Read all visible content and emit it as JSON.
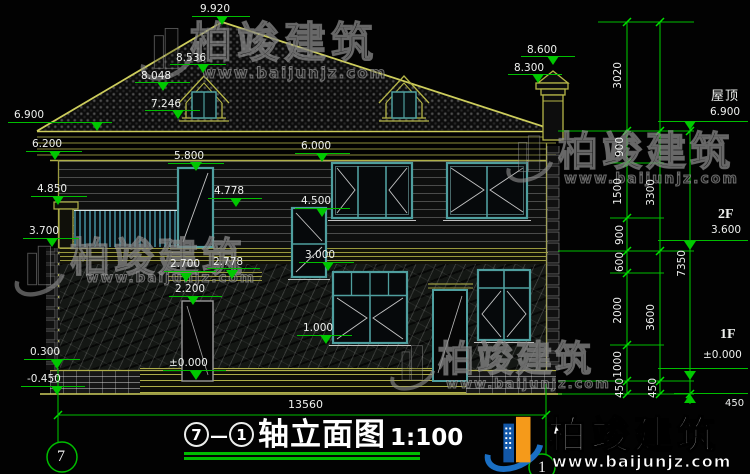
{
  "watermark": {
    "company": "柏竣建筑",
    "website": "www.baijunjz.com"
  },
  "title": {
    "axis_start": "7",
    "separator": "—",
    "axis_end": "1",
    "text": "轴立面图",
    "scale": "1:100"
  },
  "axis_bubbles": {
    "left": "7",
    "right": "1"
  },
  "overall_dimension": "13560",
  "annotations": {
    "levels": [
      {
        "text": "9.920",
        "x": 200,
        "y": 3,
        "line": [
          192,
          250,
          16
        ],
        "tri": [
          222,
          25
        ]
      },
      {
        "text": "8.536",
        "x": 176,
        "y": 52,
        "line": [
          170,
          226,
          64
        ],
        "tri": [
          203,
          73
        ]
      },
      {
        "text": "8.048",
        "x": 141,
        "y": 70,
        "line": [
          135,
          190,
          82
        ],
        "tri": [
          163,
          91
        ]
      },
      {
        "text": "7.246",
        "x": 151,
        "y": 98,
        "line": [
          145,
          200,
          110
        ],
        "tri": [
          178,
          119
        ]
      },
      {
        "text": "8.600",
        "x": 527,
        "y": 44,
        "line": [
          521,
          575,
          56
        ],
        "tri": [
          553,
          65
        ]
      },
      {
        "text": "8.300",
        "x": 514,
        "y": 62,
        "line": [
          508,
          562,
          74
        ],
        "tri": [
          538,
          83
        ]
      },
      {
        "text": "6.900",
        "x": 14,
        "y": 109,
        "line": [
          8,
          112,
          122
        ],
        "tri": [
          97,
          131
        ]
      },
      {
        "text": "6.200",
        "x": 32,
        "y": 138,
        "line": [
          26,
          82,
          151
        ],
        "tri": [
          55,
          160
        ]
      },
      {
        "text": "5.800",
        "x": 174,
        "y": 150,
        "line": [
          168,
          224,
          163
        ],
        "tri": [
          196,
          171
        ]
      },
      {
        "text": "6.000",
        "x": 301,
        "y": 140,
        "line": [
          295,
          350,
          153
        ],
        "tri": [
          322,
          162
        ]
      },
      {
        "text": "4.850",
        "x": 37,
        "y": 183,
        "line": [
          31,
          87,
          196
        ],
        "tri": [
          58,
          205
        ]
      },
      {
        "text": "4.778",
        "x": 214,
        "y": 185,
        "line": [
          208,
          262,
          198
        ],
        "tri": [
          236,
          207
        ]
      },
      {
        "text": "4.500",
        "x": 301,
        "y": 195,
        "line": [
          295,
          350,
          208
        ],
        "tri": [
          322,
          217
        ]
      },
      {
        "text": "3.700",
        "x": 29,
        "y": 225,
        "line": [
          23,
          79,
          238
        ],
        "tri": [
          52,
          247
        ]
      },
      {
        "text": "3.000",
        "x": 305,
        "y": 249,
        "line": [
          299,
          354,
          262
        ],
        "tri": [
          328,
          271
        ]
      },
      {
        "text": "2.700",
        "x": 170,
        "y": 258,
        "line": [
          164,
          216,
          271
        ],
        "tri": [
          186,
          282
        ]
      },
      {
        "text": "2.778",
        "x": 213,
        "y": 256,
        "line": [
          207,
          260,
          268
        ],
        "tri": [
          232,
          279
        ]
      },
      {
        "text": "2.200",
        "x": 175,
        "y": 283,
        "line": [
          169,
          222,
          296
        ],
        "tri": [
          193,
          305
        ]
      },
      {
        "text": "1.000",
        "x": 303,
        "y": 322,
        "line": [
          297,
          352,
          335
        ],
        "tri": [
          326,
          344
        ]
      },
      {
        "text": "±0.000",
        "x": 169,
        "y": 357,
        "line": [
          163,
          226,
          370
        ],
        "tri": [
          196,
          380
        ]
      },
      {
        "text": "0.300",
        "x": 30,
        "y": 346,
        "line": [
          24,
          80,
          359
        ],
        "tri": [
          57,
          369
        ]
      },
      {
        "text": "-0.450",
        "x": 27,
        "y": 373,
        "line": [
          21,
          85,
          386
        ],
        "tri": [
          57,
          395
        ]
      },
      {
        "text": "屋顶",
        "x": 711,
        "y": 91,
        "fs": 13,
        "cjk": true
      },
      {
        "text": "6.900",
        "x": 710,
        "y": 106,
        "line": [
          658,
          748,
          121
        ],
        "tri": [
          690,
          130
        ]
      },
      {
        "text": "2F",
        "x": 718,
        "y": 209,
        "fs": 14,
        "bold": true
      },
      {
        "text": "3.600",
        "x": 711,
        "y": 224,
        "line": [
          658,
          748,
          240
        ],
        "tri": [
          690,
          250
        ]
      },
      {
        "text": "1F",
        "x": 720,
        "y": 329,
        "fs": 14,
        "bold": true
      },
      {
        "text": "±0.000",
        "x": 703,
        "y": 349,
        "line": [
          658,
          748,
          368
        ],
        "tri": [
          690,
          380
        ]
      },
      {
        "text": "450",
        "x": 725,
        "y": 398,
        "fs": 10,
        "line": [
          674,
          748,
          393
        ],
        "tri": [
          690,
          394
        ],
        "up": true
      },
      {
        "text": "13560",
        "x": 288,
        "y": 399,
        "fs": 11
      }
    ],
    "chain_dims": [
      {
        "text": "3020",
        "x": 612,
        "y": 62
      },
      {
        "text": "900",
        "x": 614,
        "y": 137
      },
      {
        "text": "1500",
        "x": 612,
        "y": 178
      },
      {
        "text": "900",
        "x": 614,
        "y": 225
      },
      {
        "text": "600",
        "x": 614,
        "y": 252
      },
      {
        "text": "2000",
        "x": 612,
        "y": 297
      },
      {
        "text": "1000",
        "x": 612,
        "y": 351
      },
      {
        "text": "450",
        "x": 614,
        "y": 378
      },
      {
        "text": "3300",
        "x": 645,
        "y": 179
      },
      {
        "text": "3600",
        "x": 645,
        "y": 304
      },
      {
        "text": "450",
        "x": 647,
        "y": 378
      },
      {
        "text": "7350",
        "x": 676,
        "y": 250
      }
    ]
  }
}
